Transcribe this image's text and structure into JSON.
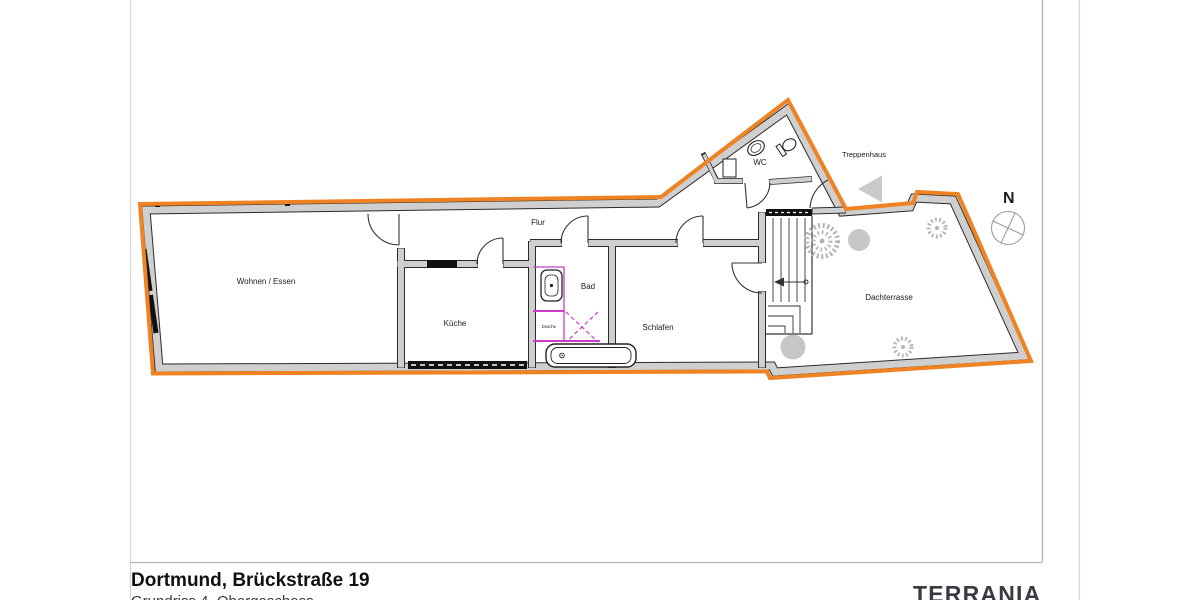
{
  "document": {
    "title": "Dortmund, Brückstraße 19",
    "subtitle": "Grundriss 4. Obergeschoss",
    "brand": "TERRANIA"
  },
  "plan": {
    "rooms": [
      {
        "id": "wohnen-essen",
        "label": "Wohnen / Essen"
      },
      {
        "id": "kueche",
        "label": "Küche"
      },
      {
        "id": "flur",
        "label": "Flur"
      },
      {
        "id": "bad",
        "label": "Bad"
      },
      {
        "id": "dusche",
        "label": "Dusche"
      },
      {
        "id": "schlafen",
        "label": "Schlafen"
      },
      {
        "id": "wc",
        "label": "WC"
      },
      {
        "id": "treppenhaus",
        "label": "Treppenhaus"
      },
      {
        "id": "dachterrasse",
        "label": "Dachterrasse"
      }
    ],
    "compass_label": "N",
    "colors": {
      "outline": "#EF8222",
      "wall_fill": "#CFCFCF",
      "wall_edge": "#2B2B2B",
      "fixture_accent": "#C83CC8",
      "vegetation": "#C6C6C6",
      "vegetation_stroke": "#B3B3B3",
      "frame_line": "#B4B4B4"
    }
  }
}
